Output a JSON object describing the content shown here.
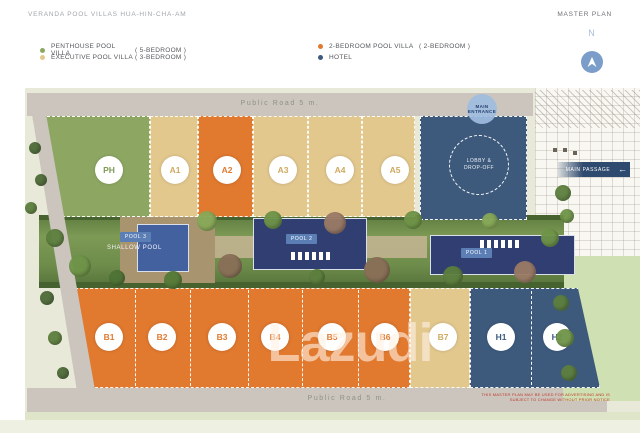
{
  "header": {
    "title": "VERANDA POOL VILLAS HUA-HIN-CHA-AM",
    "plan_label": "MASTER PLAN"
  },
  "legend": {
    "items": [
      {
        "label": "PENTHOUSE POOL VILLA",
        "detail": "( 5-BEDROOM )",
        "color": "#8DA763",
        "type": "penthouse"
      },
      {
        "label": "EXECUTIVE POOL VILLA",
        "detail": "( 3-BEDROOM )",
        "color": "#E3C88E",
        "type": "executive"
      },
      {
        "label": "2-BEDROOM POOL VILLA",
        "detail": "( 2-BEDROOM )",
        "color": "#E1792F",
        "type": "two-bedroom"
      },
      {
        "label": "HOTEL",
        "detail": "",
        "color": "#3D5A7D",
        "type": "hotel"
      }
    ]
  },
  "compass": {
    "label": "N"
  },
  "map": {
    "roads": {
      "top": "Public Road 5 m.",
      "bottom": "Public Road 5 m."
    },
    "entrance": {
      "line1": "MAIN",
      "line2": "ENTRANCE"
    },
    "lobby": {
      "line1": "LOBBY &",
      "line2": "DROP-OFF"
    },
    "passage": {
      "label": "MAIN PASSAGE",
      "arrow": "←"
    },
    "pools": {
      "pool1": "POOL 1",
      "pool2": "POOL 2",
      "pool3": "POOL 3",
      "shallow": "SHALLOW POOL"
    },
    "units_top": [
      {
        "id": "PH",
        "type": "penthouse"
      },
      {
        "id": "A1",
        "type": "executive"
      },
      {
        "id": "A2",
        "type": "two-bedroom"
      },
      {
        "id": "A3",
        "type": "executive"
      },
      {
        "id": "A4",
        "type": "executive"
      },
      {
        "id": "A5",
        "type": "executive"
      }
    ],
    "units_bottom": [
      {
        "id": "B1",
        "type": "two-bedroom"
      },
      {
        "id": "B2",
        "type": "two-bedroom"
      },
      {
        "id": "B3",
        "type": "two-bedroom"
      },
      {
        "id": "B4",
        "type": "two-bedroom"
      },
      {
        "id": "B5",
        "type": "two-bedroom"
      },
      {
        "id": "B6",
        "type": "two-bedroom"
      },
      {
        "id": "B7",
        "type": "executive"
      },
      {
        "id": "H1",
        "type": "hotel"
      },
      {
        "id": "H2",
        "type": "hotel"
      }
    ],
    "watermark": "Lazudi",
    "disclaimer": {
      "line1": "THIS MASTER PLAN MAY BE USED FOR ADVERTISING AND IS",
      "line2": "SUBJECT TO CHANGE WITHOUT PRIOR NOTICE"
    }
  },
  "colors": {
    "penthouse": "#8DA763",
    "executive": "#E3C88E",
    "two_bedroom": "#E1792F",
    "hotel": "#3D5A7D",
    "road": "#CBC5BD",
    "map_background": "#E8E9D9",
    "pool_water": "#303E72",
    "pool_badge": "#5B7FB5",
    "entrance_badge": "#9FBCE0",
    "passage_navy": "#2E4A6E",
    "lawn": "#CFE0B2",
    "disclaimer_red": "#C0392B"
  }
}
